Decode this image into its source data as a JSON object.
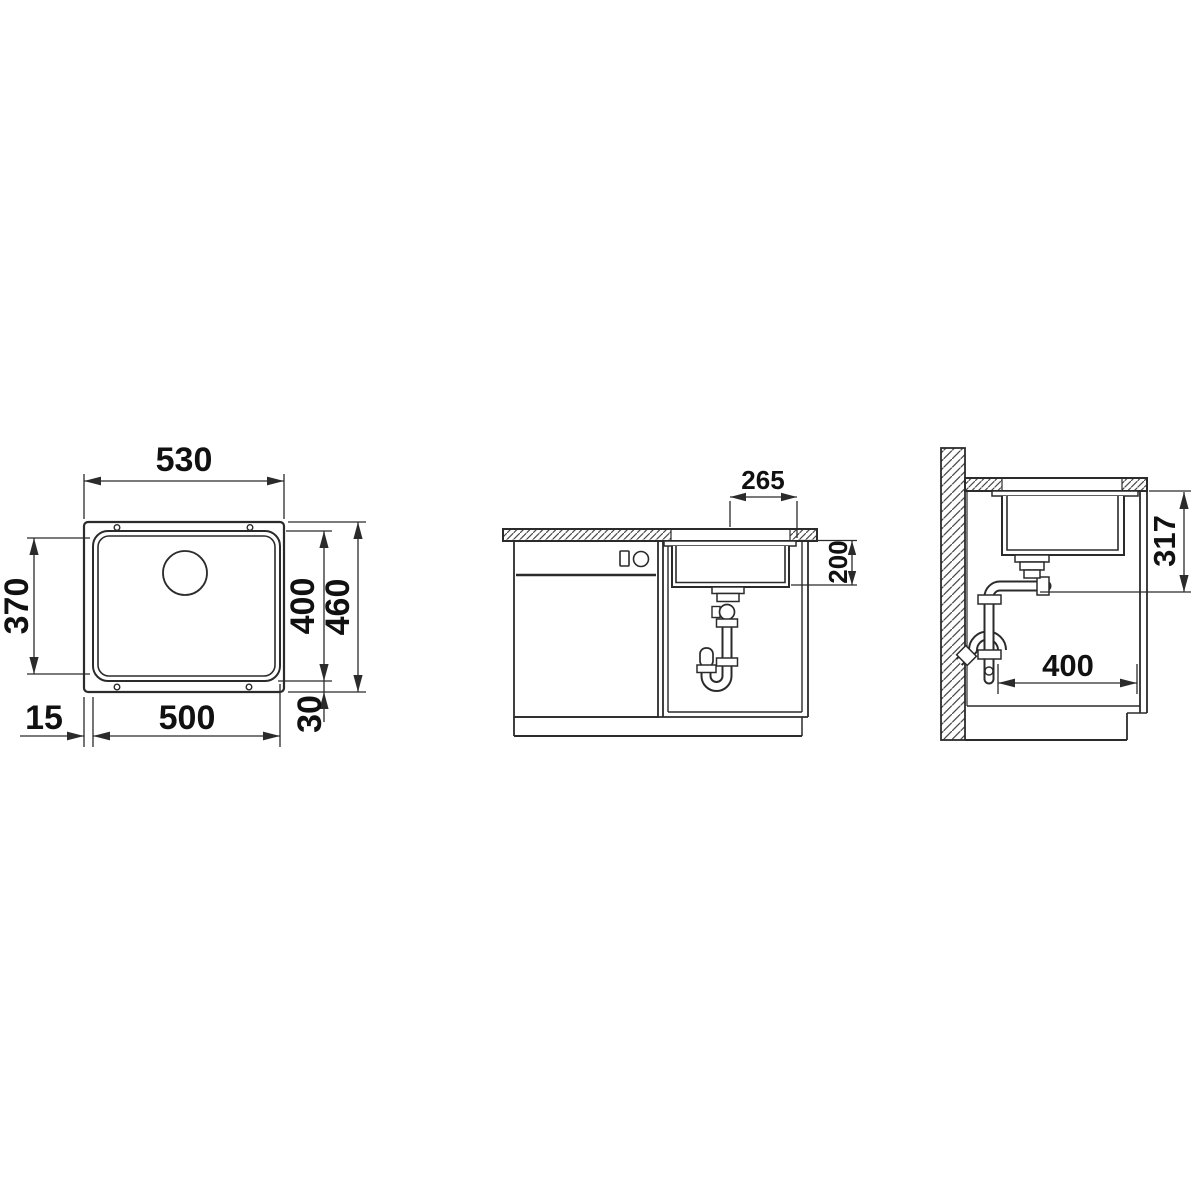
{
  "diagram": {
    "type": "sink-installation-technical-drawing",
    "background": "#ffffff",
    "line_color": "#2b2b2b",
    "views": {
      "top": {
        "name": "top-view-plan",
        "dims": {
          "outer_width": "530",
          "inner_height": "370",
          "bowl_height": "400",
          "outer_height": "460",
          "edge_offset": "15",
          "bowl_width": "500",
          "bottom_offset": "30"
        }
      },
      "front": {
        "name": "front-section-view",
        "dims": {
          "center_to_edge": "265",
          "bowl_depth": "200"
        }
      },
      "side": {
        "name": "side-section-view",
        "dims": {
          "rim_to_outlet": "317",
          "bowl_front_to_back": "400"
        }
      }
    }
  }
}
